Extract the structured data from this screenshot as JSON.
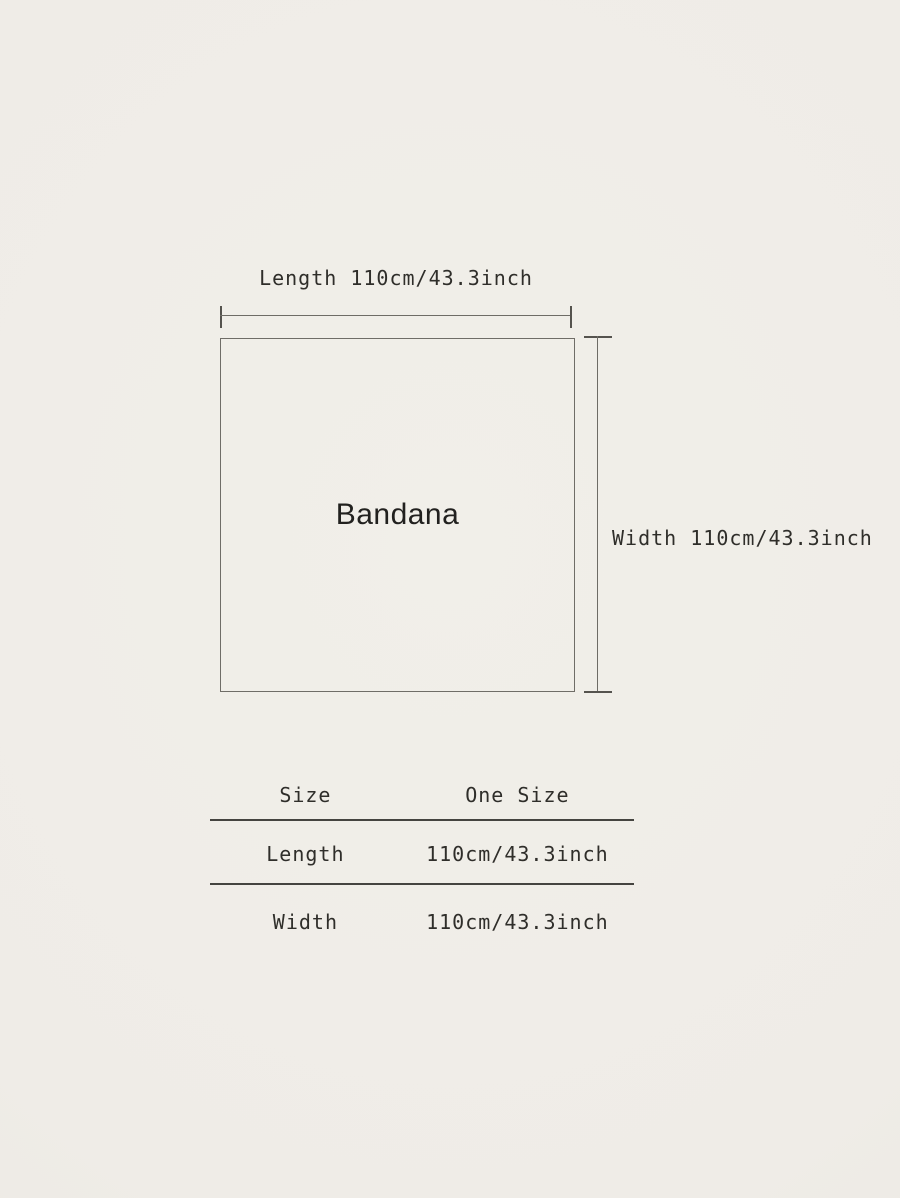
{
  "colors": {
    "background_center": "#f1efe9",
    "background_edge": "#e8e5de",
    "outline": "#6f6d67",
    "measure_line": "#55534e",
    "table_rule": "#454440",
    "text": "#2f2e2a"
  },
  "diagram": {
    "shape_label": "Bandana",
    "length_label": "Length 110cm/43.3inch",
    "width_label": "Width 110cm/43.3inch"
  },
  "size_table": {
    "columns": [
      "Size",
      "One Size"
    ],
    "rows": [
      {
        "label": "Length",
        "value": "110cm/43.3inch"
      },
      {
        "label": "Width",
        "value": "110cm/43.3inch"
      }
    ]
  }
}
